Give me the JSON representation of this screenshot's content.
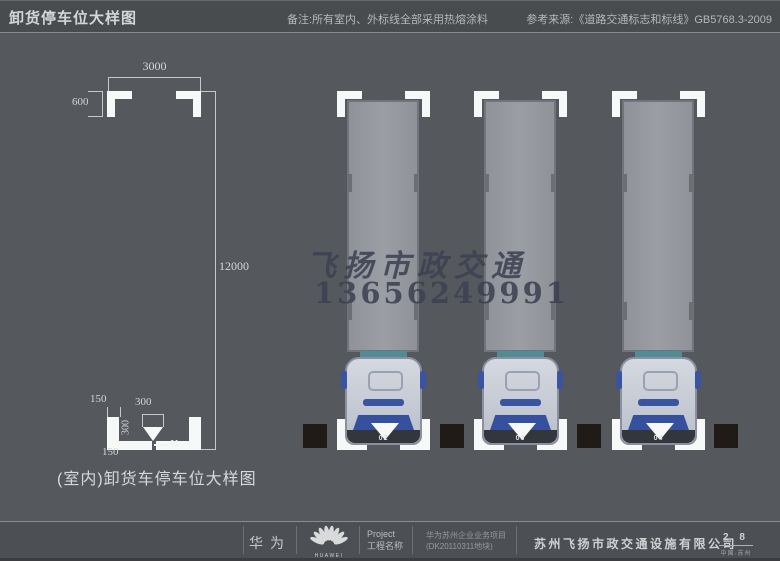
{
  "header": {
    "title": "卸货停车位大样图",
    "note": "备注:所有室内、外标线全部采用热熔涂料",
    "reference": "参考来源:《道路交通标志和标线》GB5768.3-2009"
  },
  "drawing": {
    "dim_top_width": "3000",
    "dim_side_length": "12000",
    "dim_corner_leg_top": "600",
    "dim_corner_leg_bottom": "600",
    "dim_stroke_150_top": "150",
    "dim_marker_300": "300",
    "dim_side_300": "300",
    "dim_stroke_150_bottom": "150",
    "stall_label": "01",
    "caption": "(室内)卸货车停车位大样图"
  },
  "watermark": {
    "line1": "飞扬市政交通",
    "line2": "13656249991"
  },
  "stalls": {
    "truck_numbers": [
      "02",
      "03",
      "04"
    ]
  },
  "footer": {
    "brand": "华为",
    "logo_word": "HUAWEI",
    "project_label_en": "Project",
    "project_label_zh": "工程名称",
    "project_name_line1": "华为苏州企业业务项目",
    "project_name_line2": "(DK20110311地块)",
    "company": "苏州飞扬市政交通设施有限公司",
    "page_number": "2 8",
    "location": "中国·苏州"
  },
  "colors": {
    "marking_white": "#f7f8f8",
    "accent_blue": "#3a549f",
    "teal": "#4f8c93",
    "watermark": "#3d4152",
    "black_block": "#201b17",
    "headlight": "#bf7b3c"
  }
}
